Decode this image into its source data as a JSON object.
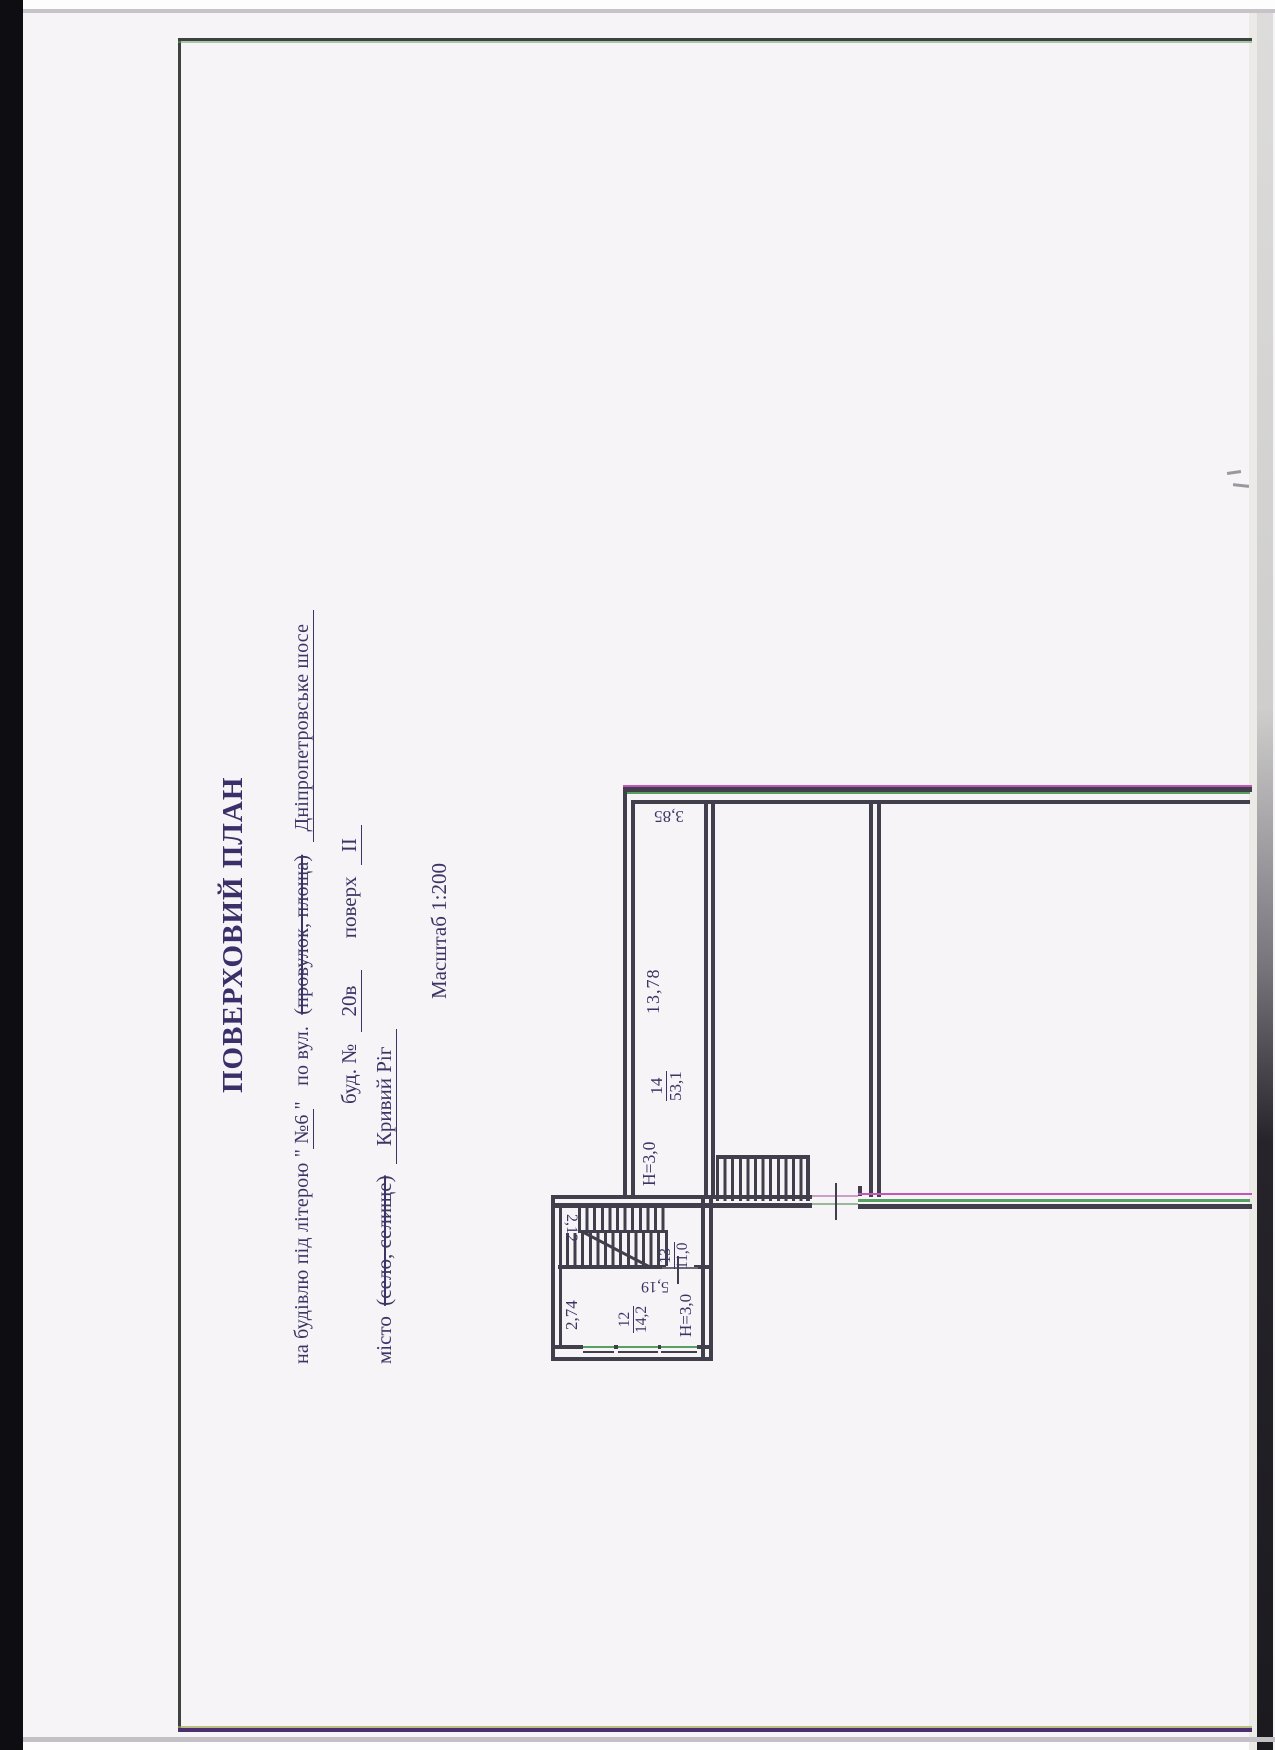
{
  "form": {
    "title": "ПОВЕРХОВИЙ ПЛАН",
    "building_line": {
      "prefix": "на будівлю під літерою \"",
      "letter": "№6",
      "close_quote": "\"",
      "street_label": "по вул.",
      "struck": "(провулок, площа)",
      "street": "Дніпропетровське шосе"
    },
    "house_line": {
      "label": "буд. №",
      "number": "20в",
      "floor_label": "поверх",
      "floor": "II"
    },
    "city_line": {
      "label": "місто",
      "struck": "(село, селище)",
      "city": "Кривий Ріг"
    },
    "scale": "Масштаб 1:200"
  },
  "plan": {
    "corridor": {
      "number": "14",
      "area": "53,1",
      "width": "3,85",
      "length": "13,78",
      "height": "Н=3,0"
    },
    "stairwell": {
      "number": "13",
      "area": "11,0",
      "stair_width": "2,12"
    },
    "room12": {
      "number": "12",
      "area": "14,2",
      "width": "2,74",
      "length": "5,19",
      "height": "Н=3,0"
    }
  },
  "colors": {
    "ink": "#3b3566",
    "wall": "#413f4c",
    "fringe_magenta": "#c455bd",
    "fringe_green": "#58a061",
    "paper": "#f6f4f6"
  }
}
